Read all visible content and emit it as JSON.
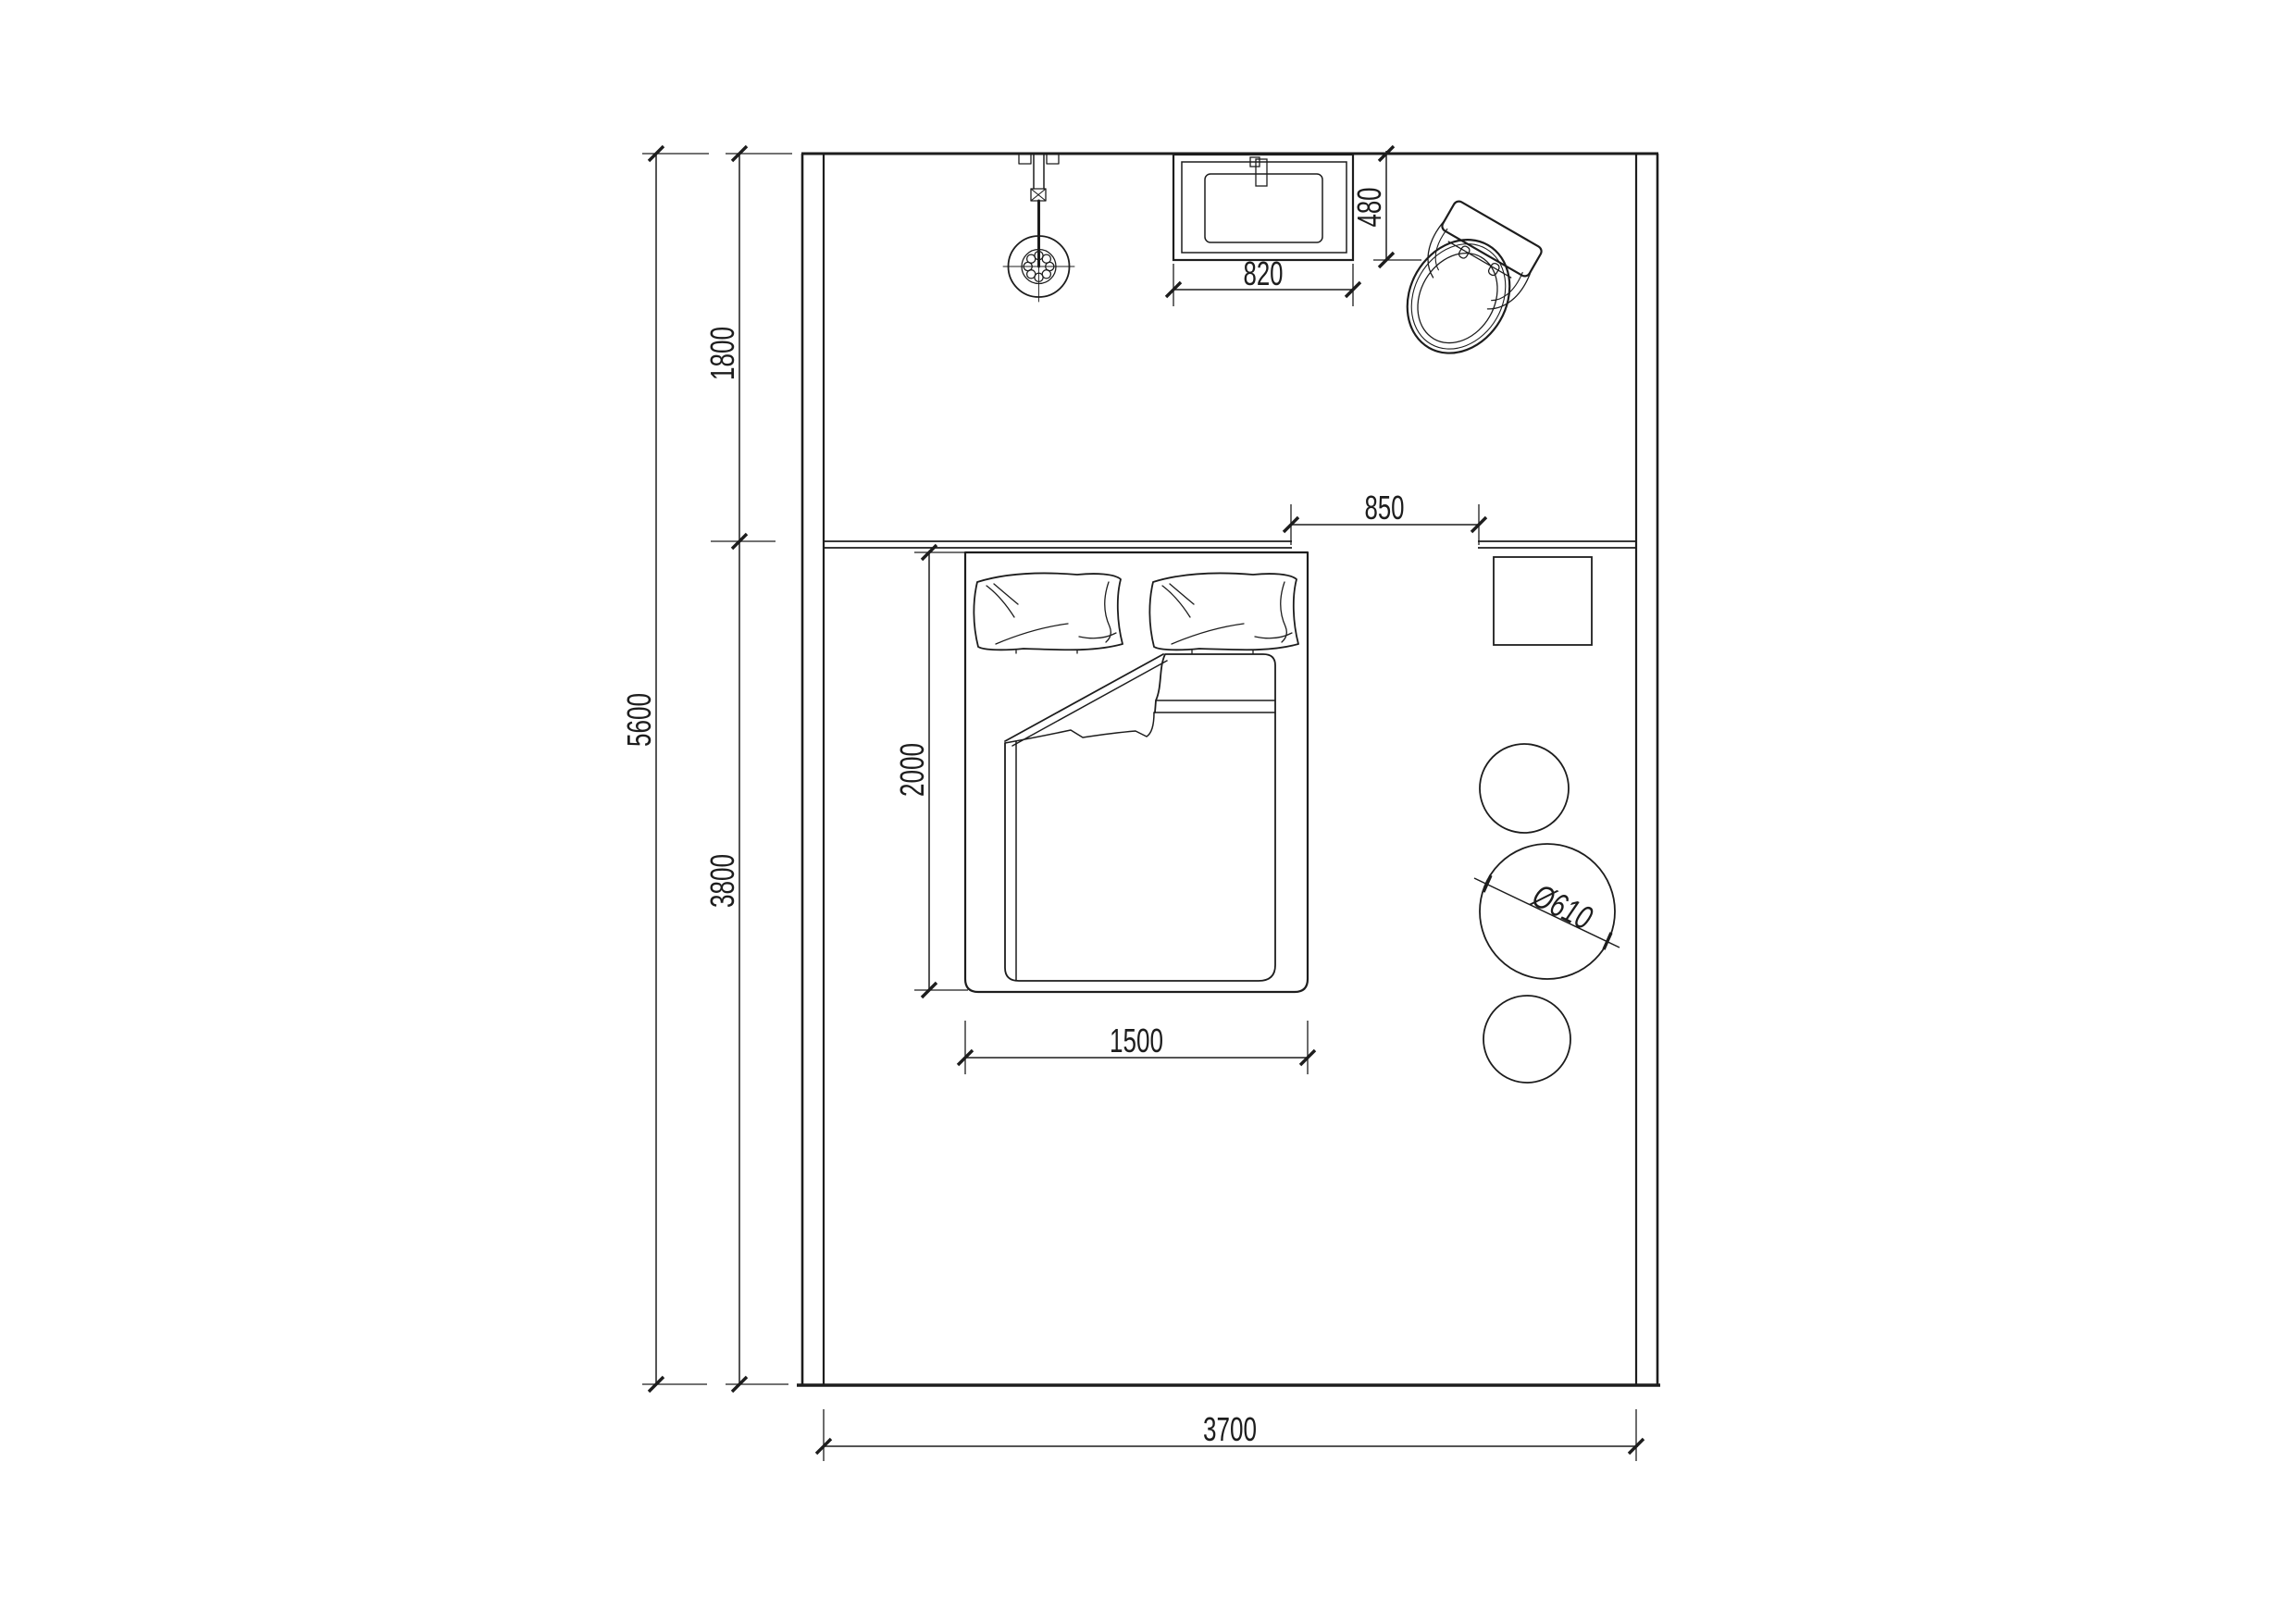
{
  "drawing": {
    "background": "#ffffff",
    "line_color": "#1d1d1d",
    "dimensions": {
      "room_depth_total": "5600",
      "upper_zone_depth": "1800",
      "lower_zone_depth": "3800",
      "room_width": "3700",
      "bed_length": "2000",
      "bed_width": "1500",
      "wall_opening": "850",
      "basin_width": "820",
      "basin_depth": "480",
      "table_diameter": "Ø610"
    }
  }
}
